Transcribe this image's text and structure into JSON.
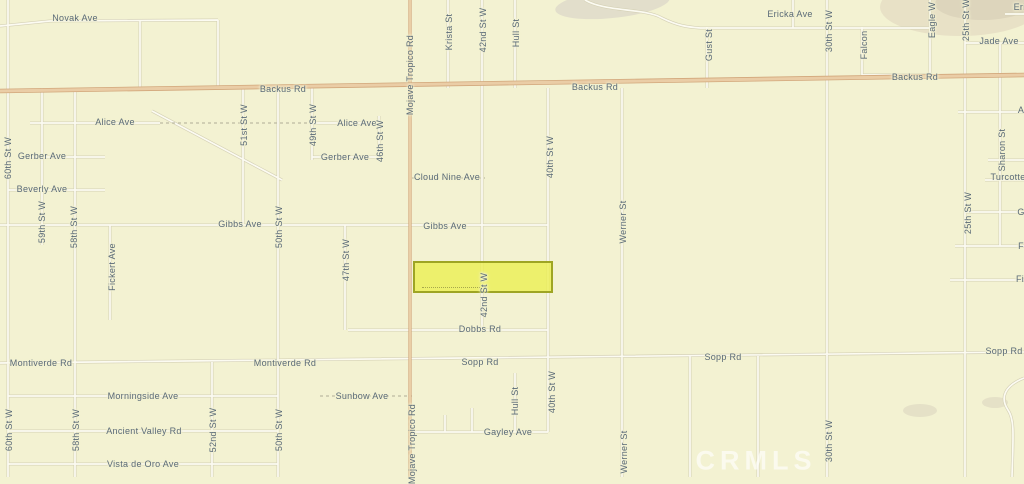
{
  "map": {
    "watermark": "CRMLS",
    "colors": {
      "background": "#f3f2d2",
      "road_fill": "#fcfbf2",
      "road_casing": "#d5d1b6",
      "highway_fill": "#eacda6",
      "highway_casing": "#d2a77b",
      "label_text": "#5a6a77",
      "parcel_fill": "#ebf05e",
      "parcel_border": "#9aa12b",
      "watermark_color": "#ffffff"
    },
    "parcel": {
      "x": 413,
      "y": 261,
      "width": 140,
      "height": 32
    },
    "labels": [
      {
        "t": "Novak Ave",
        "x": 75,
        "y": 18,
        "v": 0
      },
      {
        "t": "Backus Rd",
        "x": 283,
        "y": 89,
        "v": 0
      },
      {
        "t": "Backus Rd",
        "x": 595,
        "y": 87,
        "v": 0
      },
      {
        "t": "Backus Rd",
        "x": 915,
        "y": 77,
        "v": 0
      },
      {
        "t": "Ericka Ave",
        "x": 790,
        "y": 14,
        "v": 0
      },
      {
        "t": "Ericka",
        "x": 1027,
        "y": 7,
        "v": 0
      },
      {
        "t": "Jade Ave",
        "x": 999,
        "y": 41,
        "v": 0
      },
      {
        "t": "Alice Ave",
        "x": 115,
        "y": 122,
        "v": 0
      },
      {
        "t": "Alice Ave",
        "x": 357,
        "y": 123,
        "v": 0
      },
      {
        "t": "Gerber Ave",
        "x": 42,
        "y": 156,
        "v": 0
      },
      {
        "t": "Gerber Ave",
        "x": 345,
        "y": 157,
        "v": 0
      },
      {
        "t": "Beverly Ave",
        "x": 42,
        "y": 189,
        "v": 0
      },
      {
        "t": "Cloud Nine Ave",
        "x": 447,
        "y": 177,
        "v": 0
      },
      {
        "t": "Turcotte",
        "x": 1008,
        "y": 177,
        "v": 0
      },
      {
        "t": "Gibbs Ave",
        "x": 240,
        "y": 224,
        "v": 0
      },
      {
        "t": "Gibbs Ave",
        "x": 445,
        "y": 226,
        "v": 0
      },
      {
        "t": "Dobbs Rd",
        "x": 480,
        "y": 329,
        "v": 0
      },
      {
        "t": "Montiverde Rd",
        "x": 41,
        "y": 363,
        "v": 0
      },
      {
        "t": "Montiverde Rd",
        "x": 285,
        "y": 363,
        "v": 0
      },
      {
        "t": "Sopp Rd",
        "x": 480,
        "y": 362,
        "v": 0
      },
      {
        "t": "Sopp Rd",
        "x": 723,
        "y": 357,
        "v": 0
      },
      {
        "t": "Sopp Rd",
        "x": 1004,
        "y": 351,
        "v": 0
      },
      {
        "t": "Morningside Ave",
        "x": 143,
        "y": 396,
        "v": 0
      },
      {
        "t": "Sunbow Ave",
        "x": 362,
        "y": 396,
        "v": 0
      },
      {
        "t": "Ancient Valley Rd",
        "x": 144,
        "y": 431,
        "v": 0
      },
      {
        "t": "Gayley Ave",
        "x": 508,
        "y": 432,
        "v": 0
      },
      {
        "t": "Vista de Oro Ave",
        "x": 143,
        "y": 464,
        "v": 0
      },
      {
        "t": "A",
        "x": 1021,
        "y": 110,
        "v": 0
      },
      {
        "t": "G",
        "x": 1021,
        "y": 212,
        "v": 0
      },
      {
        "t": "F",
        "x": 1021,
        "y": 246,
        "v": 0
      },
      {
        "t": "Fi",
        "x": 1020,
        "y": 279,
        "v": 0
      },
      {
        "t": "Mojave Tropico Rd",
        "x": 410,
        "y": 75,
        "v": 1
      },
      {
        "t": "Mojave Tropico Rd",
        "x": 412,
        "y": 444,
        "v": 1
      },
      {
        "t": "Krista St",
        "x": 449,
        "y": 32,
        "v": 1
      },
      {
        "t": "42nd St W",
        "x": 483,
        "y": 30,
        "v": 1
      },
      {
        "t": "Hull St",
        "x": 516,
        "y": 33,
        "v": 1
      },
      {
        "t": "40th St W",
        "x": 550,
        "y": 157,
        "v": 1
      },
      {
        "t": "42nd St W",
        "x": 484,
        "y": 295,
        "v": 1
      },
      {
        "t": "Hull St",
        "x": 515,
        "y": 401,
        "v": 1
      },
      {
        "t": "40th St W",
        "x": 552,
        "y": 392,
        "v": 1
      },
      {
        "t": "Werner St",
        "x": 623,
        "y": 222,
        "v": 1
      },
      {
        "t": "Werner St",
        "x": 624,
        "y": 452,
        "v": 1
      },
      {
        "t": "Gust St",
        "x": 709,
        "y": 45,
        "v": 1
      },
      {
        "t": "30th St W",
        "x": 829,
        "y": 31,
        "v": 1
      },
      {
        "t": "30th St W",
        "x": 829,
        "y": 441,
        "v": 1
      },
      {
        "t": "Falcon",
        "x": 864,
        "y": 45,
        "v": 1
      },
      {
        "t": "Eagle W",
        "x": 932,
        "y": 20,
        "v": 1
      },
      {
        "t": "25th St W",
        "x": 966,
        "y": 20,
        "v": 1
      },
      {
        "t": "25th St W",
        "x": 968,
        "y": 213,
        "v": 1
      },
      {
        "t": "Sharon St",
        "x": 1002,
        "y": 150,
        "v": 1
      },
      {
        "t": "60th St W",
        "x": 8,
        "y": 158,
        "v": 1
      },
      {
        "t": "60th St W",
        "x": 9,
        "y": 430,
        "v": 1
      },
      {
        "t": "59th St W",
        "x": 42,
        "y": 222,
        "v": 1
      },
      {
        "t": "58th St W",
        "x": 74,
        "y": 227,
        "v": 1
      },
      {
        "t": "58th St W",
        "x": 76,
        "y": 430,
        "v": 1
      },
      {
        "t": "Fickert Ave",
        "x": 112,
        "y": 267,
        "v": 1
      },
      {
        "t": "51st St W",
        "x": 244,
        "y": 125,
        "v": 1
      },
      {
        "t": "50th St W",
        "x": 279,
        "y": 227,
        "v": 1
      },
      {
        "t": "50th St W",
        "x": 279,
        "y": 430,
        "v": 1
      },
      {
        "t": "52nd St W",
        "x": 213,
        "y": 430,
        "v": 1
      },
      {
        "t": "49th St W",
        "x": 313,
        "y": 125,
        "v": 1
      },
      {
        "t": "47th St W",
        "x": 346,
        "y": 260,
        "v": 1
      },
      {
        "t": "46th St W",
        "x": 380,
        "y": 141,
        "v": 1
      }
    ]
  }
}
